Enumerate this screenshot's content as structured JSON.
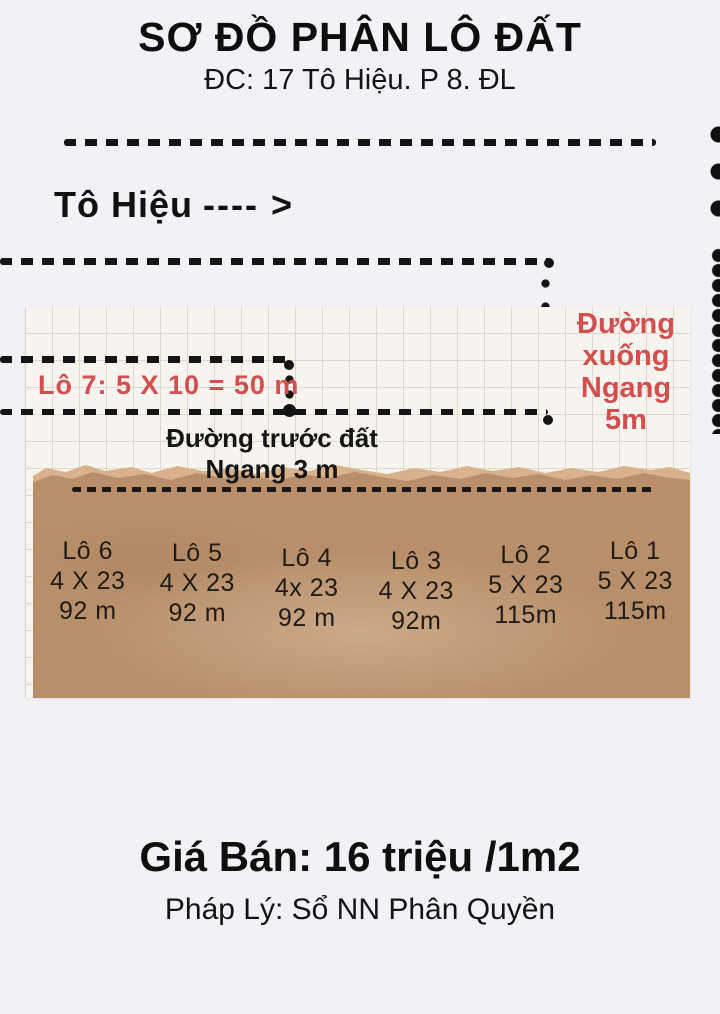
{
  "title": "SƠ ĐỒ PHÂN LÔ ĐẤT",
  "address": "ĐC: 17 Tô Hiệu. P 8. ĐL",
  "street": {
    "name": "Tô Hiệu",
    "arrow": "---- >"
  },
  "diagram": {
    "lot7_label": "Lô 7:  5 X 10 = 50 m",
    "side_road": {
      "line1": "Đường",
      "line2": "xuống",
      "line3": "Ngang 5m"
    },
    "front_road": {
      "line1": "Đường trước đất",
      "line2": "Ngang 3 m"
    },
    "plots": [
      {
        "name": "Lô 6",
        "dims": "4 X 23",
        "area": "92 m"
      },
      {
        "name": "Lô 5",
        "dims": "4 X 23",
        "area": "92 m"
      },
      {
        "name": "Lô 4",
        "dims": "4x 23",
        "area": "92 m"
      },
      {
        "name": "Lô 3",
        "dims": "4 X 23",
        "area": "92m"
      },
      {
        "name": "Lô 2",
        "dims": "5 X 23",
        "area": "115m"
      },
      {
        "name": "Lô 1",
        "dims": "5 X 23",
        "area": "115m"
      }
    ]
  },
  "footer": {
    "price": "Giá Bán: 16 triệu /1m2",
    "legal": "Pháp Lý: Sổ NN Phân Quyền"
  },
  "colors": {
    "accent_red": "#d24f4e",
    "ink": "#151515",
    "kraft_paper": "#b88f6a",
    "grid_paper": "#f7f4ef",
    "background": "#f2f2f6"
  }
}
